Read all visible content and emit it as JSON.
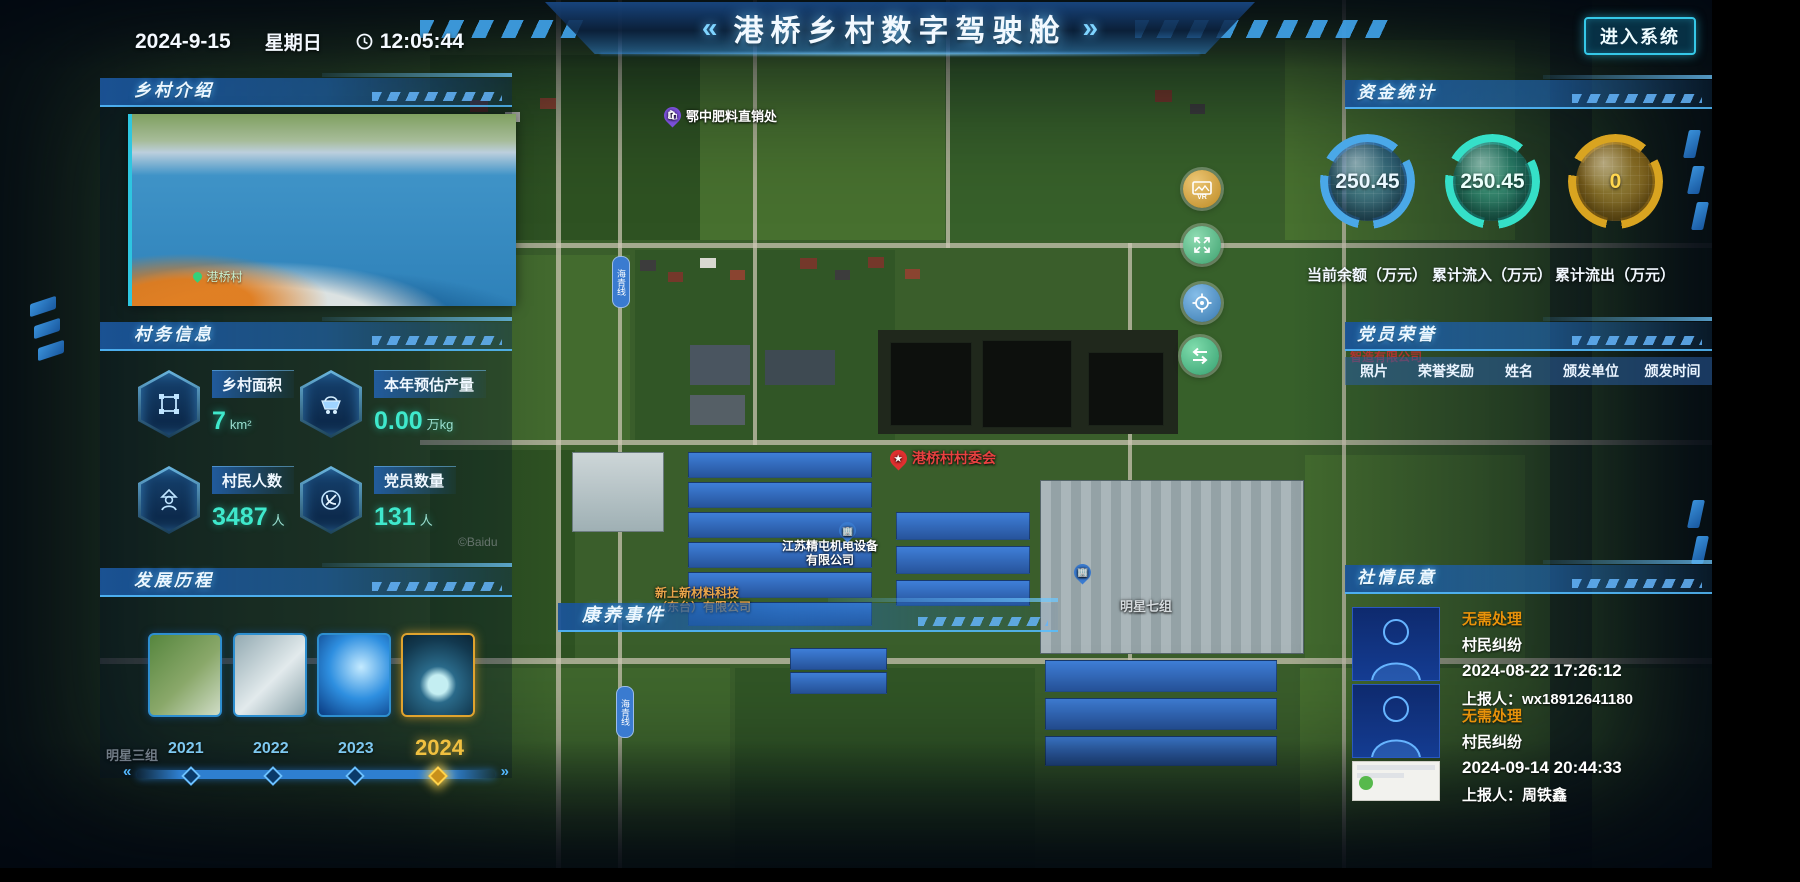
{
  "header": {
    "date": "2024-9-15",
    "weekday": "星期日",
    "time": "12:05:44",
    "title": "港桥乡村数字驾驶舱",
    "arrow_left": "«",
    "arrow_right": "»",
    "enter_button": "进入系统"
  },
  "village_intro": {
    "title": "乡村介绍",
    "photo_caption": "港桥村"
  },
  "village_info": {
    "title": "村务信息",
    "stats": [
      {
        "icon": "area-icon",
        "label": "乡村面积",
        "value": "7",
        "unit": "km²"
      },
      {
        "icon": "cart-icon",
        "label": "本年预估产量",
        "value": "0.00",
        "unit": "万kg"
      },
      {
        "icon": "villager-icon",
        "label": "村民人数",
        "value": "3487",
        "unit": "人"
      },
      {
        "icon": "party-icon",
        "label": "党员数量",
        "value": "131",
        "unit": "人"
      }
    ]
  },
  "development": {
    "title": "发展历程",
    "years": [
      "2021",
      "2022",
      "2023",
      "2024"
    ],
    "active_year": "2024",
    "prev_arrow": "«",
    "next_arrow": "»"
  },
  "funds": {
    "title": "资金统计",
    "gauges": [
      {
        "value": "250.45",
        "label": "当前余额（万元）",
        "color": "#4aa8e8"
      },
      {
        "value": "250.45",
        "label": "累计流入（万元）",
        "color": "#35e0c8"
      },
      {
        "value": "0",
        "label": "累计流出（万元）",
        "color": "#d9a420"
      }
    ]
  },
  "party_honor": {
    "title": "党员荣誉",
    "columns": [
      "照片",
      "荣誉奖励",
      "姓名",
      "颁发单位",
      "颁发时间"
    ]
  },
  "public_opinion": {
    "title": "社情民意",
    "entries": [
      {
        "status": "无需处理",
        "category": "村民纠纷",
        "time": "2024-08-22 17:26:12",
        "reporter": "上报人：wx18912641180"
      },
      {
        "status": "无需处理",
        "category": "村民纠纷",
        "time": "2024-09-14 20:44:33",
        "reporter": "上报人：周铁鑫"
      }
    ]
  },
  "health_events": {
    "title": "康养事件"
  },
  "map": {
    "watermark": "©Baidu",
    "vr_label": "VR",
    "labels": {
      "fertilizer": "鄂中肥料直销处",
      "committee": "港桥村村委会",
      "company1_line1": "江苏精屯机电设备",
      "company1_line2": "有限公司",
      "company2_line1": "新上新材料科技",
      "company2_line2": "（东台）有限公司",
      "group7": "明星七组",
      "group3": "明星三组",
      "company3": "智造有限公司",
      "road": "海青线"
    }
  }
}
